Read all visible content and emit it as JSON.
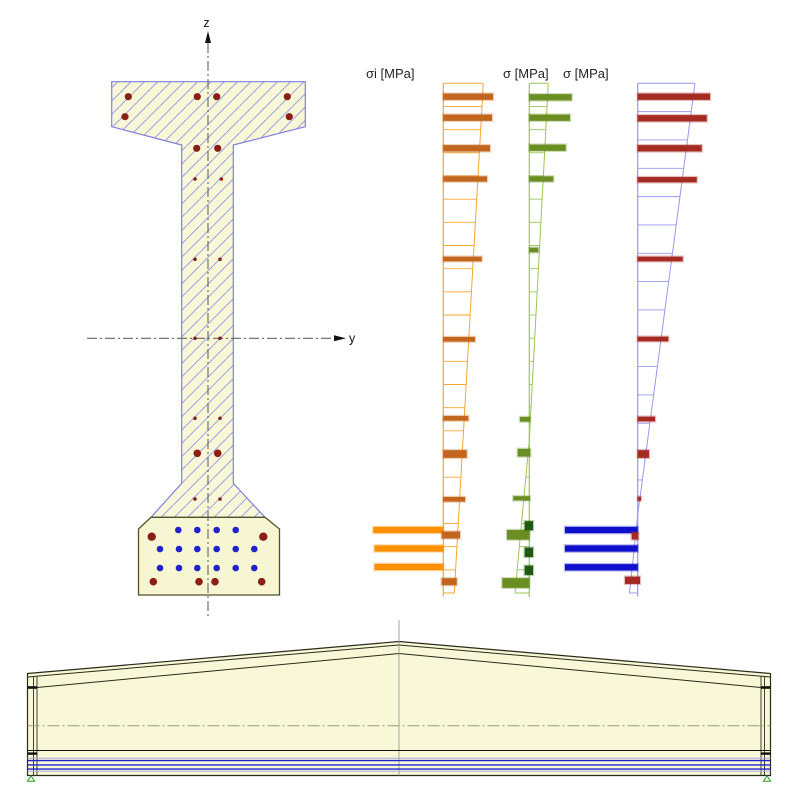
{
  "app": {
    "background": "#ffffff"
  },
  "cross_section": {
    "z_label": "z",
    "y_label": "y",
    "fill": "#F8F8D6",
    "hatch_color": "#8f8fe8",
    "outline_color": "#8080E0",
    "bulb_fill": "#F6F6D2",
    "bulb_outline_color": "#50502A",
    "hatched_outline": [
      [
        111.7,
        81.7
      ],
      [
        305.3,
        81.7
      ],
      [
        305.3,
        126.7
      ],
      [
        233.3,
        145
      ],
      [
        233.3,
        483.3
      ],
      [
        265,
        517.3
      ],
      [
        151,
        517.3
      ],
      [
        181.7,
        483.3
      ],
      [
        181.7,
        145
      ],
      [
        111.7,
        126.7
      ]
    ],
    "bulb_outline": [
      [
        151,
        517.3
      ],
      [
        265,
        517.3
      ],
      [
        279.5,
        529
      ],
      [
        279.5,
        595
      ],
      [
        138.5,
        595
      ],
      [
        138.5,
        529
      ]
    ],
    "z_axis": {
      "x": 208,
      "y1": 43,
      "y2": 618,
      "arrow_tip_y": 31
    },
    "y_axis": {
      "y": 338.3,
      "x1": 87,
      "x2": 335,
      "arrow_tip_x": 346,
      "label_x": 349,
      "label_y": 342.5
    },
    "rebar_color": "#8B1F15",
    "strand_color": "#2222CC",
    "rebar": [
      [
        128.3,
        96.7,
        3.6
      ],
      [
        197.3,
        96.7,
        3.6
      ],
      [
        216.7,
        96.7,
        3.6
      ],
      [
        287.3,
        96.7,
        3.6
      ],
      [
        125,
        116.7,
        3.6
      ],
      [
        289.3,
        116.7,
        3.6
      ],
      [
        196.7,
        148.3,
        3.6
      ],
      [
        217.7,
        148.3,
        3.6
      ],
      [
        195,
        179,
        1.8
      ],
      [
        221.3,
        179,
        1.8
      ],
      [
        195,
        259.3,
        1.8
      ],
      [
        220,
        259.3,
        1.8
      ],
      [
        195,
        338.3,
        1.8
      ],
      [
        220,
        338.3,
        1.8
      ],
      [
        195,
        418.3,
        1.8
      ],
      [
        220,
        418.3,
        1.8
      ],
      [
        197.3,
        453.3,
        3.8
      ],
      [
        217.7,
        453.3,
        3.8
      ],
      [
        195,
        499,
        1.8
      ],
      [
        220,
        499,
        1.8
      ],
      [
        151.7,
        536.7,
        4.2
      ],
      [
        263.3,
        536.7,
        4.2
      ],
      [
        153.3,
        581.7,
        3.8
      ],
      [
        199,
        581.7,
        3.8
      ],
      [
        215,
        581.7,
        3.8
      ],
      [
        261.7,
        581.7,
        3.8
      ]
    ],
    "strand_radius": 3.3,
    "strand_rows": [
      {
        "y": 530,
        "xs": [
          178.3,
          197.3,
          216.7,
          235.7
        ]
      },
      {
        "y": 549,
        "xs": [
          160,
          179,
          197.3,
          216.7,
          235.7,
          254.3
        ]
      },
      {
        "y": 568,
        "xs": [
          160,
          179,
          197.3,
          216.7,
          235.7,
          254.3
        ]
      }
    ]
  },
  "stress_diagrams": [
    {
      "name": "initial-stress-diagram",
      "label": "σi [MPa]",
      "axis_x": 443.3,
      "y_top": 83.3,
      "y_bottom": 593,
      "axis_bottom": 596.5,
      "outline_color": "#F5A62E",
      "rung_spacing": 23.17,
      "profile": [
        [
          483.3,
          83.3
        ],
        [
          454.3,
          593
        ]
      ],
      "bars": [
        {
          "y": 530,
          "x1": 373.3,
          "x2": 443.3,
          "h": 6.3,
          "color": "#FF9000"
        },
        {
          "y": 548.5,
          "x1": 374.5,
          "x2": 443.3,
          "h": 6.3,
          "color": "#FF9000"
        },
        {
          "y": 567,
          "x1": 374.5,
          "x2": 443.3,
          "h": 6.3,
          "color": "#FF9000"
        },
        {
          "y": 96.7,
          "x2": 493,
          "h": 6.3,
          "color": "#C2661F"
        },
        {
          "y": 117.7,
          "x2": 492,
          "h": 6.3,
          "color": "#C2661F"
        },
        {
          "y": 148.3,
          "x2": 490,
          "h": 6.3,
          "color": "#C2661F"
        },
        {
          "y": 179,
          "x2": 487,
          "h": 5.3,
          "color": "#C2661F"
        },
        {
          "y": 259,
          "x2": 481.7,
          "h": 4.7,
          "color": "#C2661F"
        },
        {
          "y": 339.3,
          "x2": 475,
          "h": 4.7,
          "color": "#C2661F"
        },
        {
          "y": 418.3,
          "x2": 468.3,
          "h": 4.7,
          "color": "#C2661F"
        },
        {
          "y": 454,
          "x2": 466.7,
          "h": 7.7,
          "color": "#C2661F"
        },
        {
          "y": 499.3,
          "x2": 465,
          "h": 4.7,
          "color": "#C2661F"
        },
        {
          "y": 535,
          "x1": 441.7,
          "x2": 460,
          "h": 7,
          "color": "#C2661F"
        },
        {
          "y": 581.7,
          "x1": 441.7,
          "x2": 456.7,
          "h": 7,
          "color": "#C2661F"
        }
      ]
    },
    {
      "name": "stress-diagram-green",
      "label": "σ [MPa]",
      "axis_x": 529.3,
      "y_top": 83.3,
      "y_bottom": 593,
      "axis_bottom": 597,
      "outline_color": "#9CC653",
      "rung_spacing": 23.17,
      "profile": [
        [
          548.3,
          83.3
        ],
        [
          529.3,
          440
        ],
        [
          515,
          593
        ]
      ],
      "bars": [
        {
          "y": 97.3,
          "x2": 571.7,
          "h": 6.3,
          "color": "#6B8E23"
        },
        {
          "y": 117.7,
          "x2": 570,
          "h": 6.3,
          "color": "#6B8E23"
        },
        {
          "y": 147.7,
          "x2": 565.7,
          "h": 6.3,
          "color": "#6B8E23"
        },
        {
          "y": 179,
          "x2": 553.3,
          "h": 5.3,
          "color": "#6B8E23"
        },
        {
          "y": 250,
          "x2": 538.3,
          "h": 4.7,
          "color": "#6B8E23"
        },
        {
          "y": 419.3,
          "x1": 520,
          "x2": 530,
          "h": 4.7,
          "color": "#6B8E23"
        },
        {
          "y": 452.7,
          "x1": 517.7,
          "x2": 530.3,
          "h": 7.7,
          "color": "#6B8E23"
        },
        {
          "y": 498.3,
          "x1": 513.3,
          "x2": 530,
          "h": 4.3,
          "color": "#6B8E23"
        },
        {
          "y": 534.8,
          "x1": 507,
          "x2": 529.5,
          "h": 9.7,
          "color": "#6B8E23"
        },
        {
          "y": 583,
          "x1": 502.3,
          "x2": 529.5,
          "h": 9.7,
          "color": "#6B8E23"
        },
        {
          "y": 525.7,
          "x1": 524.7,
          "x2": 533,
          "h": 9,
          "color": "#1E5A10"
        },
        {
          "y": 552.3,
          "x1": 524.7,
          "x2": 533,
          "h": 9.3,
          "color": "#1E5A10"
        },
        {
          "y": 570.3,
          "x1": 524.7,
          "x2": 533,
          "h": 9.3,
          "color": "#1E5A10"
        }
      ]
    },
    {
      "name": "stress-diagram-red",
      "label": "σ [MPa]",
      "axis_x": 637.7,
      "y_top": 83.3,
      "y_bottom": 593,
      "axis_bottom": 596.5,
      "outline_color": "#9898EE",
      "rung_spacing": 28.33,
      "profile": [
        [
          695,
          83.3
        ],
        [
          637.7,
          515
        ],
        [
          629.5,
          593
        ]
      ],
      "bars": [
        {
          "y": 530,
          "x1": 565,
          "x2": 637.7,
          "h": 6.3,
          "color": "#0F0FCC"
        },
        {
          "y": 548.5,
          "x1": 565,
          "x2": 637.7,
          "h": 6.3,
          "color": "#0F0FCC"
        },
        {
          "y": 567.3,
          "x1": 565,
          "x2": 637.7,
          "h": 6.3,
          "color": "#0F0FCC"
        },
        {
          "y": 96.7,
          "x2": 710,
          "h": 6.3,
          "color": "#A52A21"
        },
        {
          "y": 118.3,
          "x2": 706.7,
          "h": 6.3,
          "color": "#A52A21"
        },
        {
          "y": 148.3,
          "x2": 701.7,
          "h": 6.3,
          "color": "#A52A21"
        },
        {
          "y": 179.7,
          "x2": 696.7,
          "h": 5.3,
          "color": "#A52A21"
        },
        {
          "y": 259,
          "x2": 682.7,
          "h": 4.7,
          "color": "#A52A21"
        },
        {
          "y": 339,
          "x2": 668.3,
          "h": 4.7,
          "color": "#A52A21"
        },
        {
          "y": 419,
          "x2": 655,
          "h": 4.7,
          "color": "#A52A21"
        },
        {
          "y": 454,
          "x2": 649,
          "h": 7.7,
          "color": "#A52A21"
        },
        {
          "y": 498.7,
          "x2": 641,
          "h": 4,
          "color": "#A52A21"
        },
        {
          "y": 536,
          "x1": 631.7,
          "x2": 638.3,
          "h": 7,
          "color": "#A52A21"
        },
        {
          "y": 580.3,
          "x1": 625,
          "x2": 640,
          "h": 7.3,
          "color": "#A52A21"
        }
      ]
    }
  ],
  "elevation": {
    "fill": "#F8F8D8",
    "stroke": "#2B2B1A",
    "outline": [
      [
        27.5,
        673.5
      ],
      [
        399,
        641.5
      ],
      [
        770.5,
        673.5
      ],
      [
        770.5,
        775.5
      ],
      [
        27.5,
        775.5
      ]
    ],
    "top_lines": [
      [
        [
          27.5,
          677
        ],
        [
          399,
          645
        ],
        [
          770.5,
          677
        ]
      ],
      [
        [
          37,
          687.5
        ],
        [
          399,
          653.5
        ],
        [
          761,
          687.5
        ]
      ]
    ],
    "end_ticks": [
      {
        "x": 27.5,
        "y": 686.2,
        "w": 9.5,
        "h": 2.6
      },
      {
        "x": 761,
        "y": 686.2,
        "w": 9.5,
        "h": 2.6
      },
      {
        "x": 27.5,
        "y": 752.4,
        "w": 9.5,
        "h": 2.4
      },
      {
        "x": 761,
        "y": 752.4,
        "w": 9.5,
        "h": 2.4
      }
    ],
    "verticals": [
      {
        "x": 33.5,
        "y1": 676.2,
        "y2": 775.5
      },
      {
        "x": 37,
        "y1": 676.6,
        "y2": 775.5
      },
      {
        "x": 761,
        "y1": 676.6,
        "y2": 775.5
      },
      {
        "x": 764.5,
        "y1": 676.2,
        "y2": 775.5
      }
    ],
    "center_line": {
      "x": 399,
      "y1": 620,
      "y2": 775.5,
      "color": "#999999"
    },
    "centroid_line": {
      "y": 725.7,
      "x1": 27.5,
      "x2": 770.5,
      "color": "#9A9A7A"
    },
    "solid_line": {
      "y": 750.5,
      "x1": 27.5,
      "x2": 770.5
    },
    "lavender_lines": {
      "ys": [
        758.3,
        771.2
      ],
      "color": "#AAAADD"
    },
    "tendon_lines": {
      "ys": [
        760.6,
        764.9,
        769.1
      ],
      "color": "#2222CC"
    },
    "supports": {
      "xs": [
        31,
        767
      ],
      "y": 775.8,
      "color": "#2E9E2E"
    }
  }
}
